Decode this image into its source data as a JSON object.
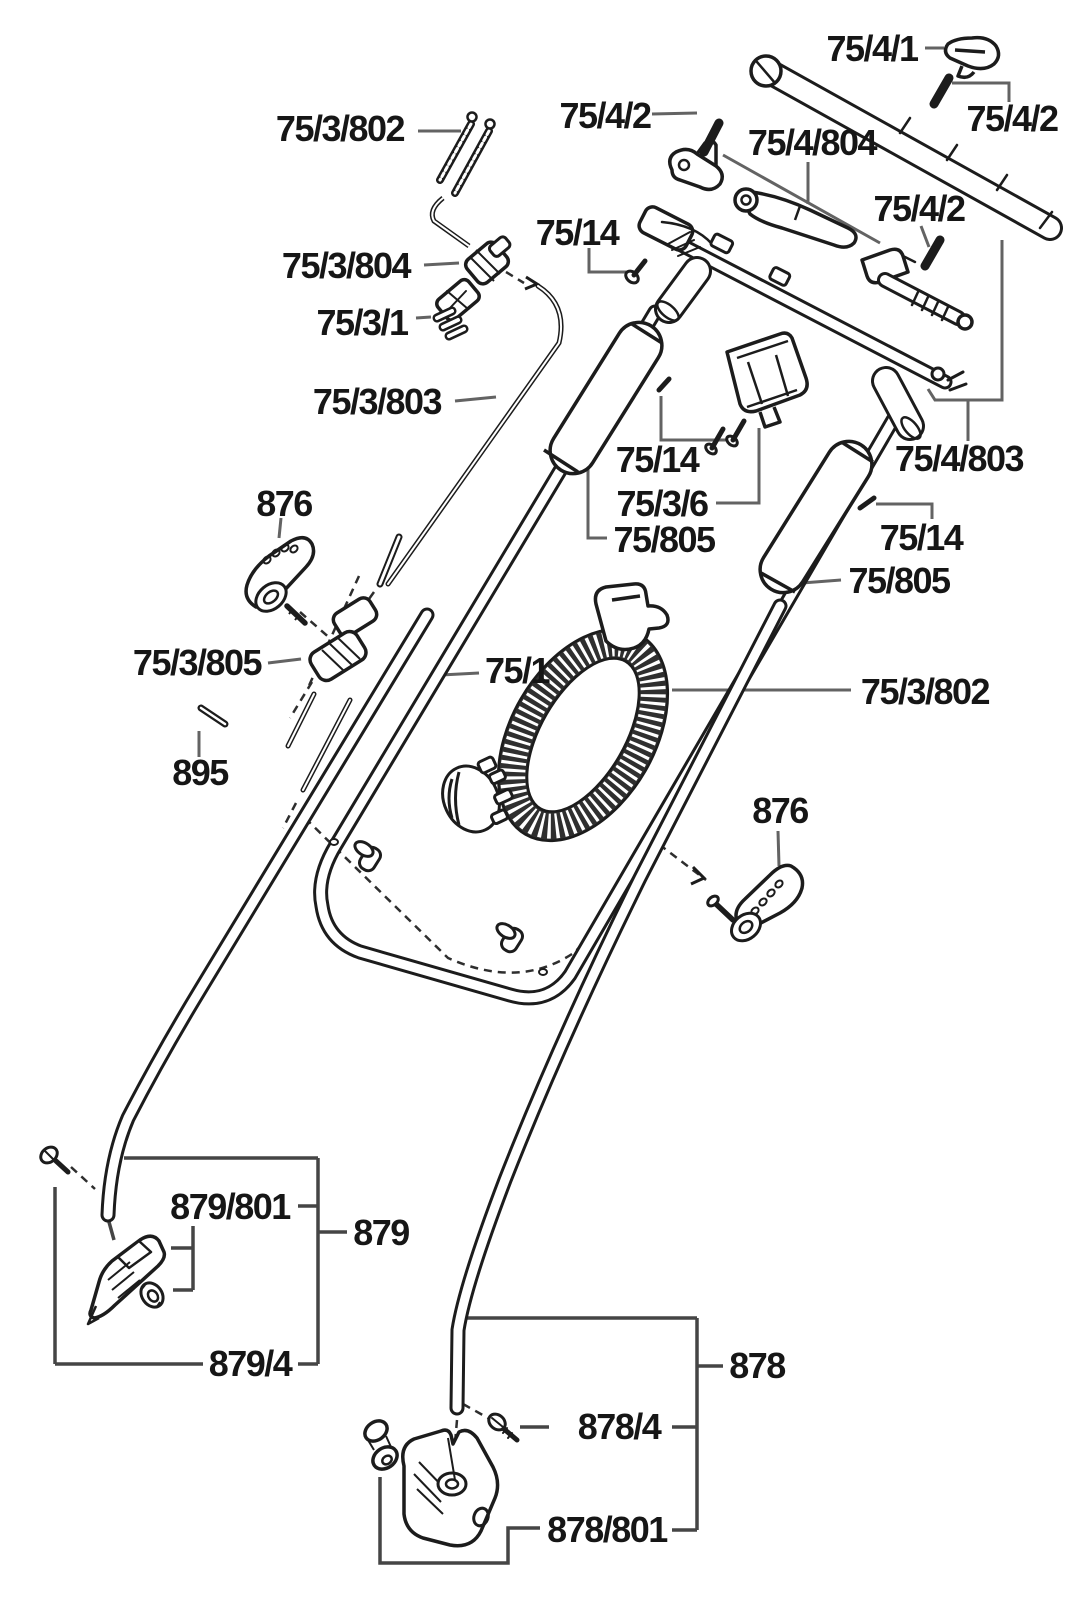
{
  "figure": {
    "kind": "exploded-parts-diagram",
    "subject": "lawn-mower handle assembly spare parts drawing",
    "background": "#ffffff"
  },
  "colors": {
    "ink": "#1c1c1c",
    "leader_line": "#636363",
    "bracket_line": "#454545",
    "coil_fill": "#2f2f2f"
  },
  "labels": [
    {
      "id": "label-75-3-802-top",
      "text": "75/3/802"
    },
    {
      "id": "label-75-4-2-topleft",
      "text": "75/4/2"
    },
    {
      "id": "label-75-4-1",
      "text": "75/4/1"
    },
    {
      "id": "label-75-4-2-topright",
      "text": "75/4/2"
    },
    {
      "id": "label-75-4-804",
      "text": "75/4/804"
    },
    {
      "id": "label-75-4-2-mid",
      "text": "75/4/2"
    },
    {
      "id": "label-75-14-top",
      "text": "75/14"
    },
    {
      "id": "label-75-3-804",
      "text": "75/3/804"
    },
    {
      "id": "label-75-3-1",
      "text": "75/3/1"
    },
    {
      "id": "label-75-3-803",
      "text": "75/3/803"
    },
    {
      "id": "label-876-left",
      "text": "876"
    },
    {
      "id": "label-75-3-805",
      "text": "75/3/805"
    },
    {
      "id": "label-895",
      "text": "895"
    },
    {
      "id": "label-75-14-center",
      "text": "75/14"
    },
    {
      "id": "label-75-3-6",
      "text": "75/3/6"
    },
    {
      "id": "label-75-805-center",
      "text": "75/805"
    },
    {
      "id": "label-75-14-right",
      "text": "75/14"
    },
    {
      "id": "label-75-805-right",
      "text": "75/805"
    },
    {
      "id": "label-75-4-803",
      "text": "75/4/803"
    },
    {
      "id": "label-75-1",
      "text": "75/1"
    },
    {
      "id": "label-75-3-802-right",
      "text": "75/3/802"
    },
    {
      "id": "label-876-right",
      "text": "876"
    },
    {
      "id": "label-879-801",
      "text": "879/801"
    },
    {
      "id": "label-879",
      "text": "879"
    },
    {
      "id": "label-879-4",
      "text": "879/4"
    },
    {
      "id": "label-878",
      "text": "878"
    },
    {
      "id": "label-878-4",
      "text": "878/4"
    },
    {
      "id": "label-878-801",
      "text": "878/801"
    }
  ],
  "art_elements": [
    "upper-switch-bar",
    "retainer-clip",
    "clevis-pins",
    "bell-crank-lever",
    "switch-lever",
    "throttle-lever-with-spring",
    "handle-crossbar",
    "spring-bolt-set",
    "cable-clamp",
    "cable-clip",
    "bowden-cable",
    "foam-grip-left",
    "foam-grip-right",
    "funnel-guide",
    "screws",
    "wing-knob-left",
    "wing-knob-right",
    "tube-clamp-halves",
    "pin",
    "upper-handle-bow",
    "coiled-cable-loop",
    "cable-plug",
    "lower-handle-tube-left",
    "lower-handle-tube-right",
    "latch-bracket",
    "bushing",
    "lower-housing",
    "swivel-piece"
  ]
}
